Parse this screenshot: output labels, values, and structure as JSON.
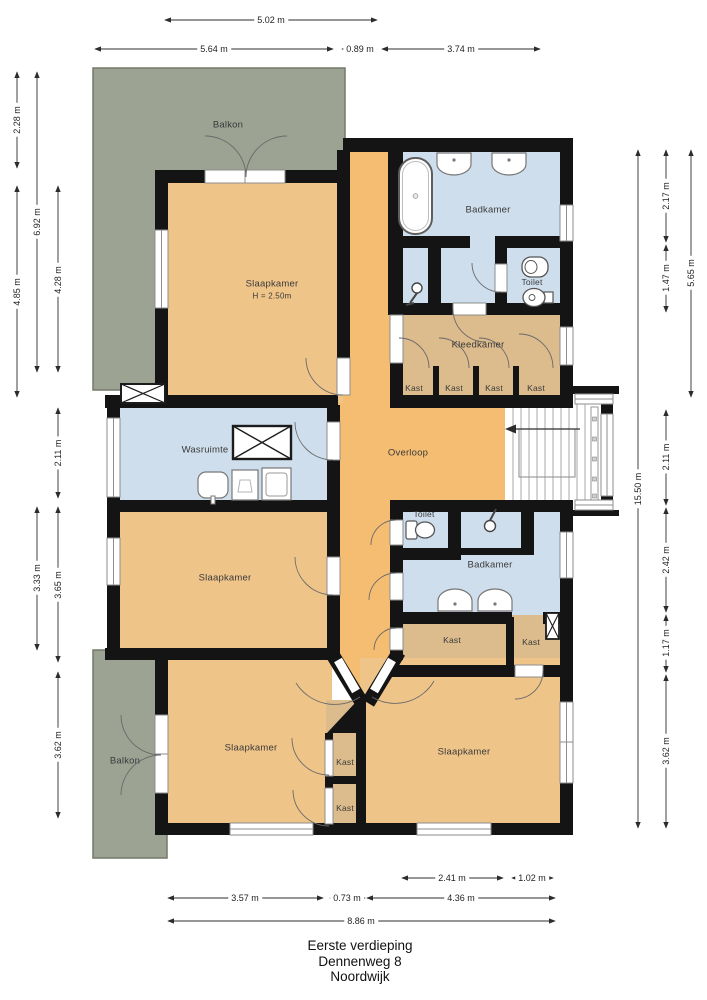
{
  "plan": {
    "title": [
      "Eerste verdieping",
      "Dennenweg 8",
      "Noordwijk"
    ],
    "rooms": [
      {
        "id": "balkon-top",
        "label": "Balkon"
      },
      {
        "id": "slaapkamer-top",
        "label": "Slaapkamer",
        "sub": "H = 2.50m"
      },
      {
        "id": "badkamer-top",
        "label": "Badkamer"
      },
      {
        "id": "toilet-top",
        "label": "Toilet"
      },
      {
        "id": "kleedkamer",
        "label": "Kleedkamer"
      },
      {
        "id": "kast-top-1",
        "label": "Kast"
      },
      {
        "id": "kast-top-2",
        "label": "Kast"
      },
      {
        "id": "kast-top-3",
        "label": "Kast"
      },
      {
        "id": "kast-top-4",
        "label": "Kast"
      },
      {
        "id": "wasruimte",
        "label": "Wasruimte"
      },
      {
        "id": "overloop",
        "label": "Overloop"
      },
      {
        "id": "toilet-mid",
        "label": "Toilet"
      },
      {
        "id": "badkamer-mid",
        "label": "Badkamer"
      },
      {
        "id": "kast-mid-left",
        "label": "Kast"
      },
      {
        "id": "kast-mid-right",
        "label": "Kast"
      },
      {
        "id": "slaapkamer-mid",
        "label": "Slaapkamer"
      },
      {
        "id": "slaapkamer-bottom-left",
        "label": "Slaapkamer"
      },
      {
        "id": "kast-center-1",
        "label": "Kast"
      },
      {
        "id": "kast-center-2",
        "label": "Kast"
      },
      {
        "id": "slaapkamer-bottom-right",
        "label": "Slaapkamer"
      },
      {
        "id": "balkon-bottom",
        "label": "Balkon"
      }
    ],
    "dimensions": {
      "top": [
        "5.02 m",
        "5.64 m",
        "0.89 m",
        "3.74 m"
      ],
      "left": [
        "2.28 m",
        "6.92 m",
        "4.85 m",
        "4.28 m",
        "2.11 m",
        "3.33 m",
        "3.65 m",
        "3.62 m"
      ],
      "right": [
        "2.17 m",
        "5.65 m",
        "1.47 m",
        "15.50 m",
        "2.11 m",
        "2.42 m",
        "1.17 m",
        "3.62 m"
      ],
      "bottom": [
        "2.41 m",
        "1.02 m",
        "3.57 m",
        "0.73 m",
        "4.36 m",
        "8.86 m"
      ]
    },
    "colors": {
      "room_orange": "#efc489",
      "hall_orange": "#f5bd72",
      "closet_tan": "#dcbb8c",
      "wet_blue": "#cfdeec",
      "balcony_green": "#9ca393",
      "wall_black": "#141414"
    }
  }
}
